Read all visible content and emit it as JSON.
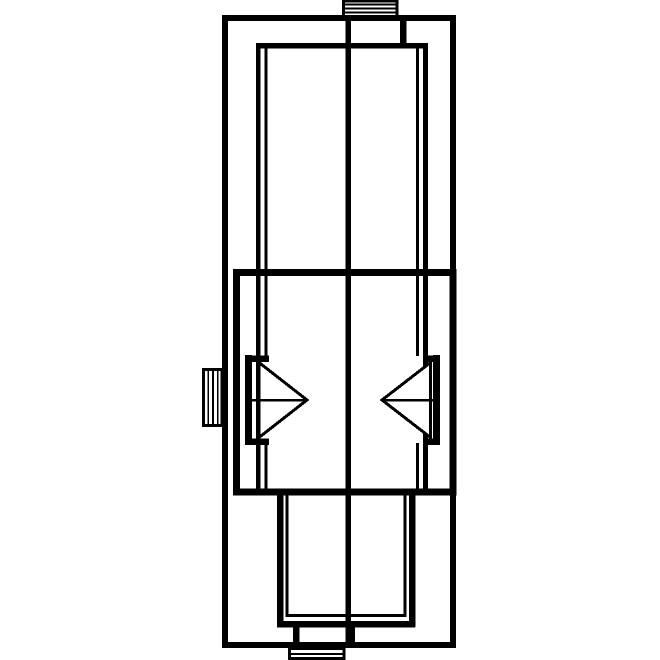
{
  "meta": {
    "kind": "technical-line-drawing",
    "description": "monochrome cross-section diagram"
  },
  "canvas": {
    "width": 660,
    "height": 660
  },
  "colors": {
    "ink": "#000000",
    "paper": "#ffffff"
  },
  "shapes": [
    {
      "name": "outer-housing-outline",
      "kind": "rect",
      "x": 225,
      "y": 18,
      "width": 228,
      "height": 627,
      "sw": 6
    },
    {
      "name": "center-axis-line",
      "kind": "line",
      "x1": 348,
      "y1": 16,
      "x2": 348,
      "y2": 646,
      "sw": 5.5
    },
    {
      "name": "top-terminal-outline",
      "kind": "rect",
      "x": 343.5,
      "y": 1,
      "width": 53.5,
      "height": 16.5,
      "sw": 2.8
    },
    {
      "name": "top-terminal-stripe-1",
      "kind": "line",
      "x1": 345,
      "y1": 4.4,
      "x2": 396,
      "y2": 4.4,
      "sw": 1.7
    },
    {
      "name": "top-terminal-stripe-2",
      "kind": "line",
      "x1": 345,
      "y1": 8.4,
      "x2": 396,
      "y2": 8.4,
      "sw": 1.7
    },
    {
      "name": "top-terminal-stripe-3",
      "kind": "line",
      "x1": 345,
      "y1": 12.4,
      "x2": 396,
      "y2": 12.4,
      "sw": 1.7
    },
    {
      "name": "top-port-wall",
      "kind": "line",
      "x1": 403,
      "y1": 17,
      "x2": 403,
      "y2": 46,
      "sw": 6.5
    },
    {
      "name": "upper-chamber-top-edge",
      "kind": "line",
      "x1": 256,
      "y1": 45.5,
      "x2": 427.5,
      "y2": 45.5,
      "sw": 5.5
    },
    {
      "name": "upper-chamber-left-wall",
      "kind": "line",
      "x1": 258,
      "y1": 43,
      "x2": 258,
      "y2": 492,
      "sw": 4.5
    },
    {
      "name": "upper-chamber-right-wall",
      "kind": "line",
      "x1": 425.5,
      "y1": 43,
      "x2": 425.5,
      "y2": 492,
      "sw": 5
    },
    {
      "name": "upper-chamber-left-liner-upper",
      "kind": "line",
      "x1": 266,
      "y1": 48,
      "x2": 266,
      "y2": 356,
      "sw": 3
    },
    {
      "name": "upper-chamber-left-liner-lower",
      "kind": "line",
      "x1": 266,
      "y1": 443,
      "x2": 266,
      "y2": 491,
      "sw": 3
    },
    {
      "name": "upper-chamber-right-liner-upper",
      "kind": "line",
      "x1": 417.5,
      "y1": 48,
      "x2": 417.5,
      "y2": 356,
      "sw": 3
    },
    {
      "name": "upper-chamber-right-liner-lower",
      "kind": "line",
      "x1": 417.5,
      "y1": 443,
      "x2": 417.5,
      "y2": 491,
      "sw": 3
    },
    {
      "name": "piston-housing-outline",
      "kind": "rect",
      "x": 236.5,
      "y": 272.5,
      "width": 216.5,
      "height": 219.5,
      "sw": 7
    },
    {
      "name": "left-seal-bar",
      "kind": "line",
      "x1": 248.5,
      "y1": 355,
      "x2": 248.5,
      "y2": 445,
      "sw": 7
    },
    {
      "name": "left-seal-arm-top",
      "kind": "line",
      "x1": 245,
      "y1": 358.5,
      "x2": 269,
      "y2": 358.5,
      "sw": 6.5
    },
    {
      "name": "left-seal-arm-bottom",
      "kind": "line",
      "x1": 245,
      "y1": 441.5,
      "x2": 269,
      "y2": 441.5,
      "sw": 6.5
    },
    {
      "name": "left-nozzle-triangle",
      "kind": "polygon",
      "points": "259,362.5 307,400 259,437.5",
      "sw": 3,
      "fill": "#ffffff"
    },
    {
      "name": "left-nozzle-centerline",
      "kind": "line",
      "x1": 248,
      "y1": 400,
      "x2": 307,
      "y2": 400,
      "sw": 2.5
    },
    {
      "name": "right-seal-bar",
      "kind": "line",
      "x1": 436.5,
      "y1": 355,
      "x2": 436.5,
      "y2": 445,
      "sw": 7
    },
    {
      "name": "right-seal-arm-top",
      "kind": "line",
      "x1": 424,
      "y1": 358.5,
      "x2": 440,
      "y2": 358.5,
      "sw": 6.5
    },
    {
      "name": "right-seal-arm-bottom",
      "kind": "line",
      "x1": 424,
      "y1": 441.5,
      "x2": 440,
      "y2": 441.5,
      "sw": 6.5
    },
    {
      "name": "right-nozzle-triangle",
      "kind": "polygon",
      "points": "430.5,362.5 382,400 430.5,437.5",
      "sw": 3,
      "fill": "#ffffff"
    },
    {
      "name": "right-nozzle-centerline",
      "kind": "line",
      "x1": 382,
      "y1": 400,
      "x2": 438,
      "y2": 400,
      "sw": 2.5
    },
    {
      "name": "left-terminal-outline",
      "kind": "rect",
      "x": 203.5,
      "y": 369.5,
      "width": 18.5,
      "height": 56,
      "sw": 3
    },
    {
      "name": "left-terminal-stripe-1",
      "kind": "line",
      "x1": 208.3,
      "y1": 371,
      "x2": 208.3,
      "y2": 424,
      "sw": 1.7
    },
    {
      "name": "left-terminal-stripe-2",
      "kind": "line",
      "x1": 213,
      "y1": 371,
      "x2": 213,
      "y2": 424,
      "sw": 1.7
    },
    {
      "name": "left-terminal-stripe-3",
      "kind": "line",
      "x1": 217.7,
      "y1": 371,
      "x2": 217.7,
      "y2": 424,
      "sw": 1.7
    },
    {
      "name": "lower-chamber-left-wall",
      "kind": "line",
      "x1": 280,
      "y1": 492,
      "x2": 280,
      "y2": 627,
      "sw": 6.5
    },
    {
      "name": "lower-chamber-right-wall",
      "kind": "line",
      "x1": 412,
      "y1": 492,
      "x2": 412,
      "y2": 627,
      "sw": 6.5
    },
    {
      "name": "lower-chamber-bottom-edge",
      "kind": "line",
      "x1": 277,
      "y1": 624,
      "x2": 415.2,
      "y2": 624,
      "sw": 6.5
    },
    {
      "name": "lower-chamber-liner",
      "kind": "polyline",
      "points": "287,494 287,615.5 405,615.5 405,494",
      "sw": 3
    },
    {
      "name": "bottom-port-wall-left",
      "kind": "line",
      "x1": 296,
      "y1": 624,
      "x2": 296,
      "y2": 646,
      "sw": 6.5
    },
    {
      "name": "bottom-port-wall-right",
      "kind": "line",
      "x1": 351.5,
      "y1": 624,
      "x2": 351.5,
      "y2": 646,
      "sw": 6.5
    },
    {
      "name": "bottom-terminal-outline",
      "kind": "rect",
      "x": 289.5,
      "y": 648.5,
      "width": 54.5,
      "height": 10,
      "sw": 2.8
    },
    {
      "name": "bottom-terminal-stripe",
      "kind": "line",
      "x1": 291,
      "y1": 653.8,
      "x2": 343,
      "y2": 653.8,
      "sw": 2
    }
  ]
}
